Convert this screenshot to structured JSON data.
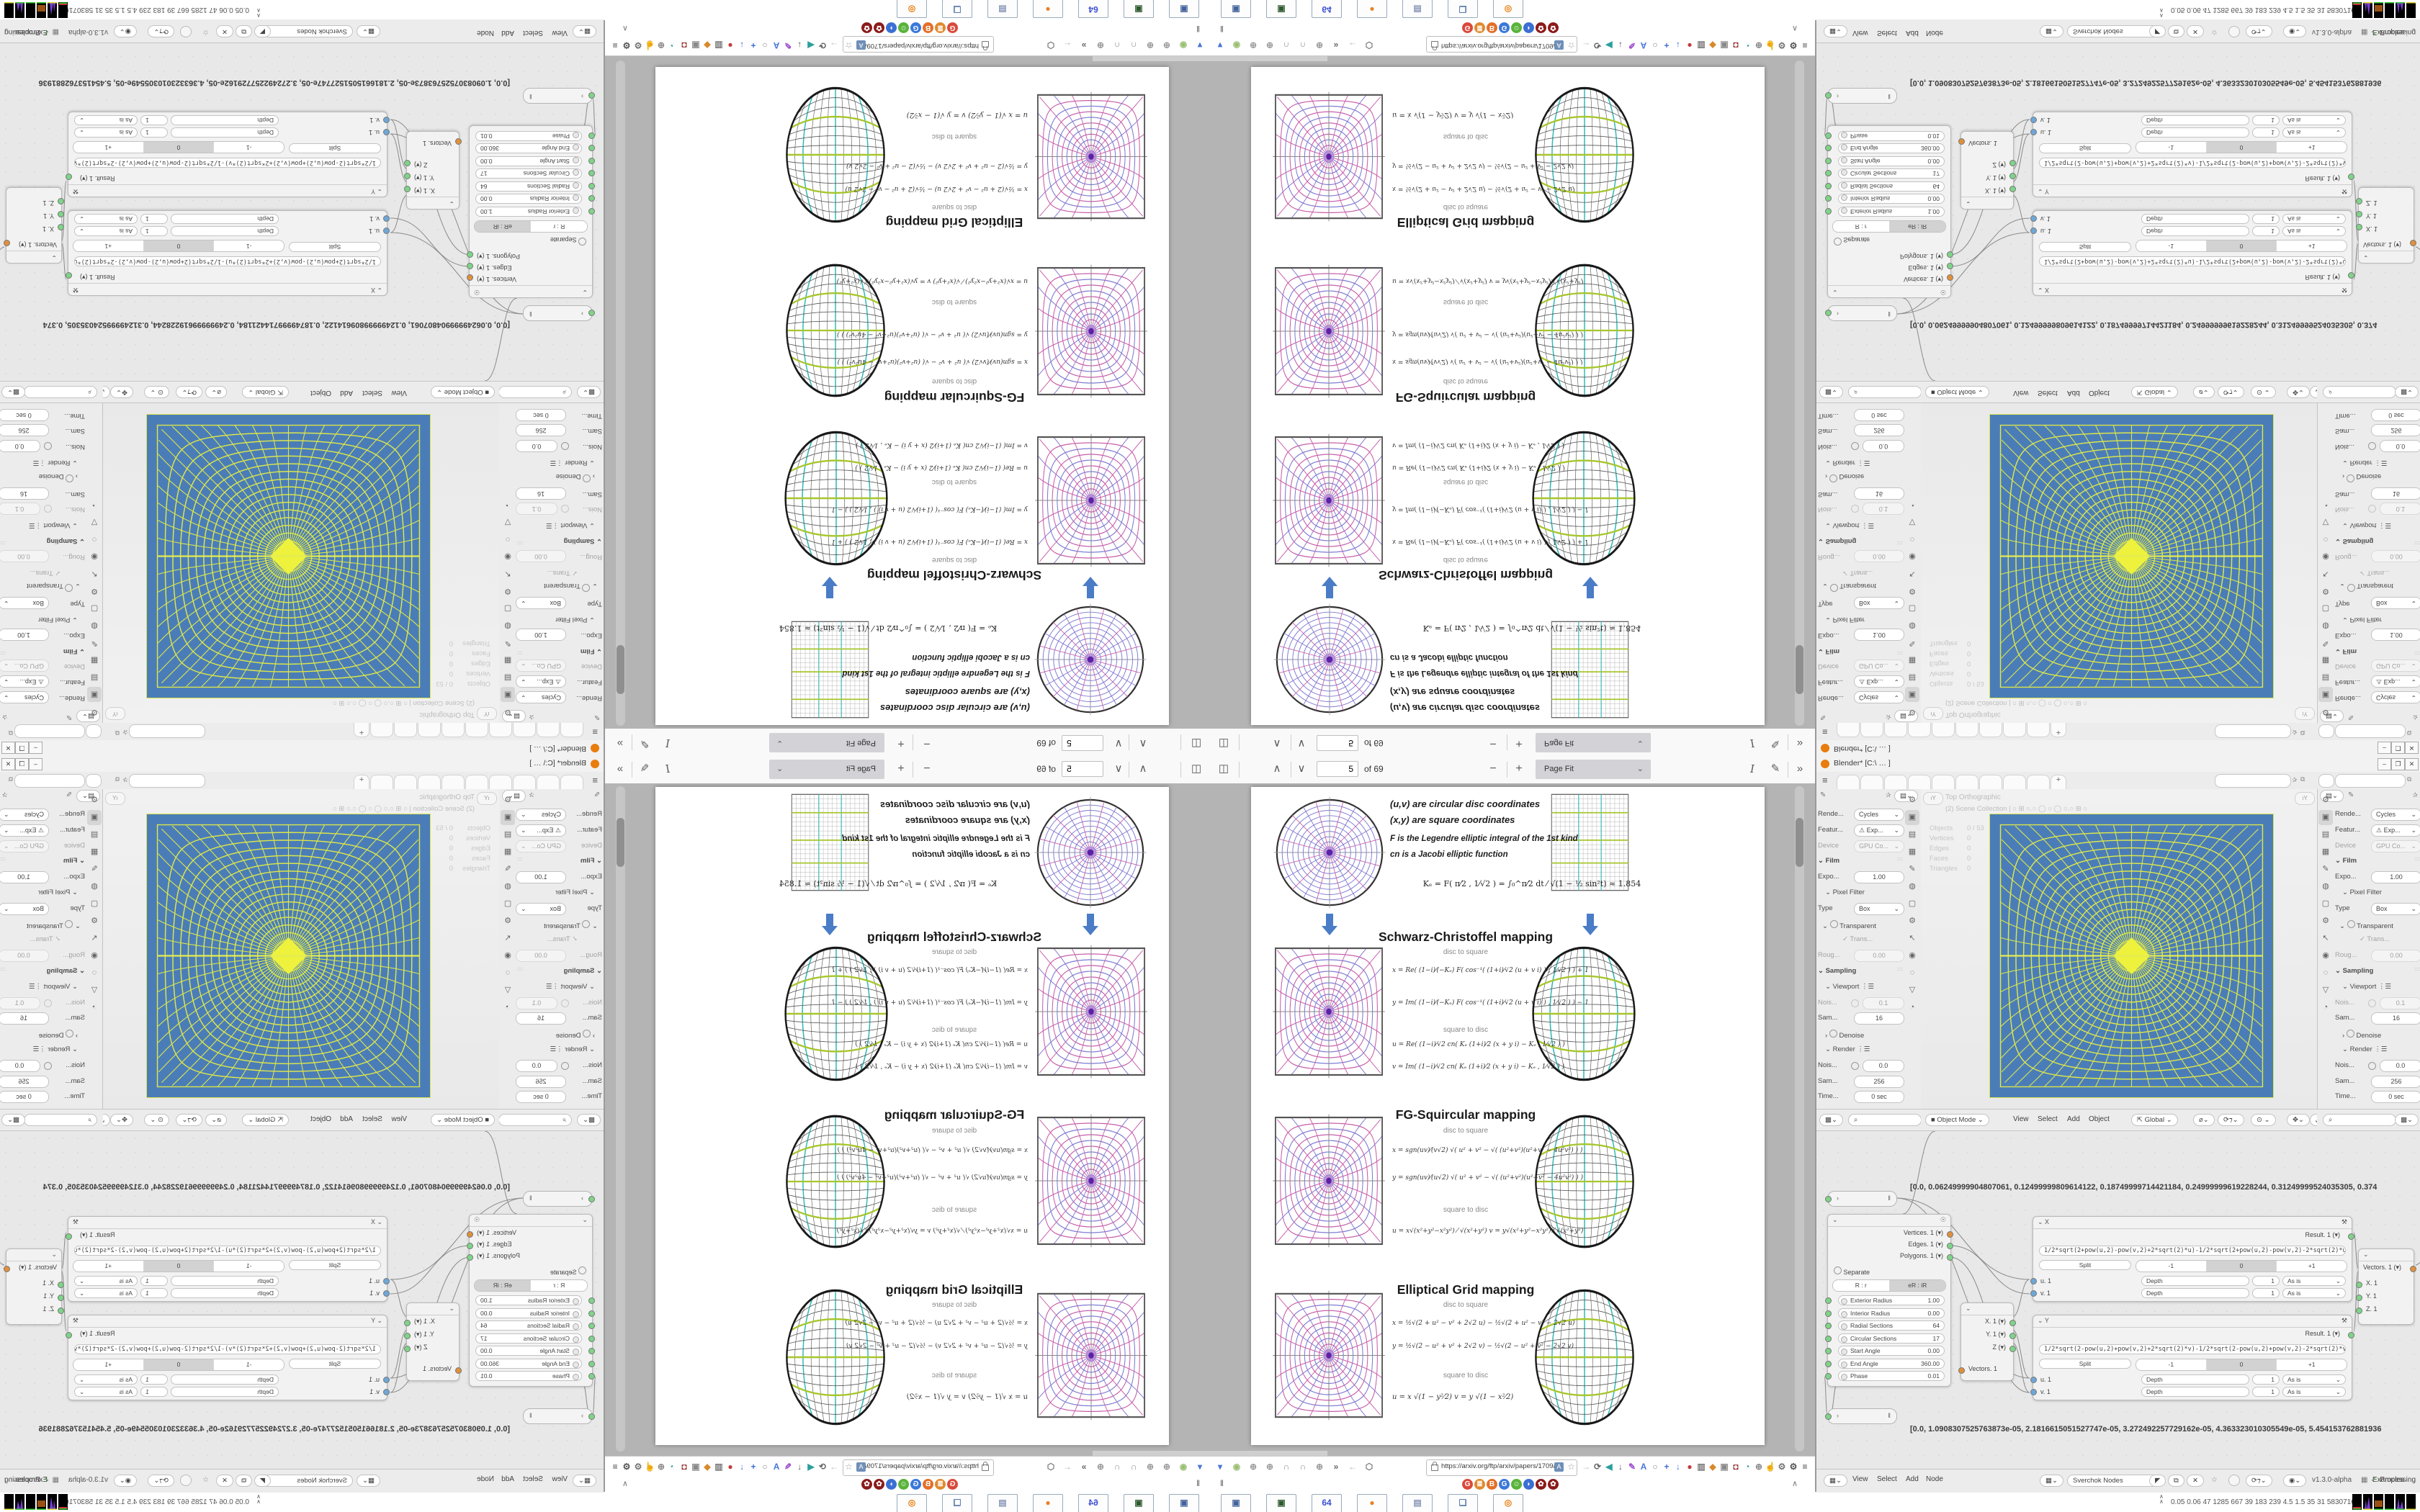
{
  "colors": {
    "accent_blue": "#4a7cc7",
    "viewport_blue": "#4a7db8",
    "grid_yellow": "#dce64a",
    "teal": "#35b8b8",
    "green_line": "#a7c62e",
    "ring_blue": "#7b7bd4",
    "radial_pink": "#c75da8"
  },
  "pdf_viewer": {
    "toolbar": {
      "page_input": "5",
      "page_count": "of 69",
      "zoom_out": "−",
      "zoom_in": "+",
      "zoom_value": "Page Fit",
      "sidebar_icon": "◫",
      "prev_icon": "∧",
      "next_icon": "∨",
      "text_tool": "I",
      "draw_tool": "✎",
      "overflow": "»"
    },
    "page": {
      "intro": [
        "(u,v)  are circular disc coordinates",
        "(x,y)  are square coordinates",
        "F  is the Legendre elliptic integral of the 1st kind",
        "cn  is a Jacobi elliptic function"
      ],
      "k_equation": "Kₑ =  F( π⁄2 , 1⁄√2 )  =  ∫₀^π⁄2  dt ⁄ √(1 − ½ sin²t)   ≈ 1.854",
      "sections": [
        {
          "title": "Schwarz-Christoffel mapping",
          "d2s_label": "disc to square",
          "s2d_label": "square to disc",
          "d2s": [
            "x = Re( (1−i)⁄(−Kₑ) F( cos⁻¹( (1+i)⁄√2 (u + v i) ) , 1⁄√2 ) ) + 1",
            "y = Im( (1−i)⁄(−Kₑ) F( cos⁻¹( (1+i)⁄√2 (u + v i) ) , 1⁄√2 ) ) − 1"
          ],
          "s2d": [
            "u = Re( (1−i)⁄√2  cn( Kₑ (1+i)⁄2 (x + y i) − Kₑ , 1⁄√2 ) )",
            "v = Im( (1−i)⁄√2  cn( Kₑ (1+i)⁄2 (x + y i) − Kₑ , 1⁄√2 ) )"
          ]
        },
        {
          "title": "FG-Squircular mapping",
          "d2s_label": "disc to square",
          "s2d_label": "square to disc",
          "d2s": [
            "x = sgn(uv)⁄(v√2) √( u² + v² − √( (u²+v²)(u²+v² − 4u²v²) ) )",
            "y = sgn(uv)⁄(u√2) √( u² + v² − √( (u²+v²)(u²+v² − 4u²v²) ) )"
          ],
          "s2d": [
            "u = x√(x²+y²−x²y²) ⁄ √(x²+y²)         v = y√(x²+y²−x²y²) ⁄ √(x²+y²)"
          ]
        },
        {
          "title": "Elliptical Grid mapping",
          "d2s_label": "disc to square",
          "s2d_label": "square to disc",
          "d2s": [
            "x = ½√(2 + u² − v² + 2√2 u)  −  ½√(2 + u² − v² − 2√2 u)",
            "y = ½√(2 − u² + v² + 2√2 v)  −  ½√(2 − u² + v² − 2√2 v)"
          ],
          "s2d": [
            "u = x √(1 − y²⁄2)             v = y √(1 − x²⁄2)"
          ]
        }
      ]
    }
  },
  "browser_chrome": {
    "url": "https://arxiv.org/ftp/arxiv/papers/1709/170",
    "left_icons": [
      {
        "g": "▾",
        "c": "#4a76d8"
      },
      {
        "g": "◉",
        "c": "#9bbf72"
      },
      {
        "g": "⊕",
        "c": "#9a9a9a"
      },
      {
        "g": "⊕",
        "c": "#9a9a9a"
      },
      {
        "g": "∩",
        "c": "#8f8f8f"
      },
      {
        "g": "∩",
        "c": "#8f8f8f"
      },
      {
        "g": "⊕",
        "c": "#9a9a9a"
      },
      {
        "g": "»",
        "c": "#666"
      },
      {
        "g": "←",
        "c": "#b0b0b0"
      },
      {
        "g": "⬡",
        "c": "#777"
      }
    ],
    "right_icons": [
      {
        "g": "→",
        "c": "#b9b9b9"
      },
      {
        "g": "⟳",
        "c": "#666"
      },
      {
        "g": "◀",
        "c": "#2e9e9e"
      },
      {
        "g": "↓",
        "c": "#555"
      },
      {
        "g": "✎",
        "c": "#a04fd0"
      },
      {
        "g": "A",
        "c": "#4a76d8"
      },
      {
        "g": "○",
        "c": "#888"
      },
      {
        "g": "+",
        "c": "#3f6fd0"
      },
      {
        "g": "↓",
        "c": "#3f6fd0"
      },
      {
        "g": "●",
        "c": "#c43c3c"
      },
      {
        "g": "▥",
        "c": "#7a7a7a"
      },
      {
        "g": "◆",
        "c": "#d98a2b"
      },
      {
        "g": "▣",
        "c": "#8a8a8a"
      },
      {
        "g": "◘",
        "c": "#8b1a1a"
      },
      {
        "g": "◔",
        "c": "#2e9e9e"
      },
      {
        "g": "⊕",
        "c": "#888"
      },
      {
        "g": "☝",
        "c": "#777"
      },
      {
        "g": "⚙",
        "c": "#777"
      },
      {
        "g": "⚙",
        "c": "#555"
      },
      {
        "g": "≡",
        "c": "#444"
      }
    ],
    "bookmarks": [
      {
        "g": "G",
        "c": "#d94a3c"
      },
      {
        "g": "≣",
        "c": "#e08a2e"
      },
      {
        "g": "B",
        "c": "#e2702a"
      },
      {
        "g": "G",
        "c": "#3b78d8"
      },
      {
        "g": "☺",
        "c": "#59b33a"
      },
      {
        "g": "◗",
        "c": "#3b6fd4"
      },
      {
        "g": "✿",
        "c": "#8b1a1a"
      },
      {
        "g": "✿",
        "c": "#8b1a1a"
      }
    ],
    "pause_glyph": "‖",
    "collapse_glyph": "∧"
  },
  "taskbar": {
    "items": [
      {
        "g": "▣",
        "c": "#44639c"
      },
      {
        "g": "▣",
        "c": "#2e5a2e"
      },
      {
        "g": "64",
        "c": "#3b4fd0"
      },
      {
        "g": "●",
        "c": "#e8822a"
      },
      {
        "g": "▤",
        "c": "#8a96b8"
      },
      {
        "g": "❏",
        "c": "#5577aa"
      },
      {
        "g": "◎",
        "c": "#e87d0d"
      }
    ]
  },
  "system_monitor": {
    "chevron": "∧",
    "values": "0.05 0.06    47    1285 667    39    183    239    4.5    1.5    35    31    58307169"
  },
  "blender": {
    "title": "Blender*  [C:\\ … ]",
    "window_buttons": [
      "–",
      "❐",
      "✕"
    ],
    "topbar": {
      "menu_glyph": "≡",
      "tab_count": 9,
      "new_tab": "+"
    },
    "props": {
      "tabs": [
        "⚙",
        "▣",
        "▤",
        "▦",
        "✎",
        "◍",
        "▢",
        "⚙",
        "↖",
        "◉",
        "◌",
        "▽",
        "◔"
      ],
      "active_tab_index": 1,
      "rows": [
        {
          "k": "dd",
          "label": "Rende...",
          "value": "Cycles"
        },
        {
          "k": "dd",
          "label": "Featur...",
          "value": "⚠ Exp..."
        },
        {
          "k": "dd",
          "label": "Device",
          "value": "GPU Co...",
          "dim": true
        },
        {
          "k": "sec",
          "label": "Film"
        },
        {
          "k": "slider",
          "label": "Expo...",
          "value": "1.00"
        },
        {
          "k": "sec2",
          "label": "Pixel Filter"
        },
        {
          "k": "dd",
          "label": "Type",
          "value": "Box"
        },
        {
          "k": "chk",
          "label": "Transparent"
        },
        {
          "k": "chk2",
          "label": "✓ Trans...",
          "dim": true
        },
        {
          "k": "slider",
          "label": "Roug...",
          "value": "0.00",
          "dim": true
        },
        {
          "k": "sec",
          "label": "Sampling"
        },
        {
          "k": "sec2",
          "label": "Viewport",
          "menu": true
        },
        {
          "k": "sliderc",
          "label": "Nois...",
          "value": "0.1",
          "dim": true
        },
        {
          "k": "slider",
          "label": "Sam...",
          "value": "16"
        },
        {
          "k": "chk3",
          "label": "Denoise"
        },
        {
          "k": "sec2",
          "label": "Render",
          "menu": true
        },
        {
          "k": "sliderc",
          "label": "Nois...",
          "value": "0.0"
        },
        {
          "k": "slider",
          "label": "Sam...",
          "value": "256"
        },
        {
          "k": "slider",
          "label": "Time...",
          "value": "0 sec"
        }
      ]
    },
    "viewport": {
      "view_label": "Top Orthographic",
      "collection_label": "(2) Scene Collection | ○ ⊞ ○.○ ◯ ○ ◯ ○.○ ⊞ ○",
      "stats": [
        [
          "Objects",
          "0 / 53"
        ],
        [
          "Vertices",
          "0"
        ],
        [
          "Edges",
          "0"
        ],
        [
          "Faces",
          "0"
        ],
        [
          "Triangles",
          "0"
        ]
      ],
      "header": {
        "mode": "Object Mode",
        "menus": [
          "View",
          "Select",
          "Add",
          "Object"
        ],
        "orientation": "Global"
      }
    },
    "node_editor": {
      "stetho_top": "[0.0, 0.06249999904807061, 0.12499999809614122, 0.18749999714421184, 0.24999999619228244, 0.31249999524035305, 0.374",
      "stetho_bottom": "[0.0, 1.0908307525763873e-05, 2.1816615051527747e-05, 3.272492257729162e-05, 4.363323010305549e-05, 5.454153762881936",
      "ring_node": {
        "outputs": [
          "Vertices. 1",
          "Edges. 1",
          "Polygons. 1"
        ],
        "separate_label": "Separate",
        "mode_options": [
          "R : r",
          "eR : iR"
        ],
        "mode_selected": 1,
        "params": [
          [
            "Exterior Radius",
            "1.00"
          ],
          [
            "Interior Radius",
            "0.00"
          ],
          [
            "Radial Sections",
            "64"
          ],
          [
            "Circular Sections",
            "17"
          ],
          [
            "Start Angle",
            "0.00"
          ],
          [
            "End Angle",
            "360.00"
          ],
          [
            "Phase",
            "0.01"
          ]
        ]
      },
      "vector_in": {
        "inputs": [
          "X. 1",
          "Y. 1",
          "Z"
        ],
        "output": "Vectors. 1"
      },
      "vector_out": {
        "input": "Vectors. 1",
        "outputs": [
          "X. 1",
          "Y. 1",
          "Z. 1"
        ]
      },
      "formula_nodes": [
        {
          "title": "X",
          "formula": "1/2*sqrt(2+pow(u,2)-pow(v,2)+2*sqrt(2)*u)-1/2*sqrt(2+pow(u,2)-pow(v,2)-2*sqrt(2)*u)",
          "result": "Result. 1",
          "wrap_options": [
            "Split",
            "-1",
            "0",
            "+1"
          ],
          "wrap_selected": 2,
          "rows": [
            [
              "u. 1",
              "Depth",
              "1",
              "As is"
            ],
            [
              "v. 1",
              "Depth",
              "1",
              "As is"
            ]
          ]
        },
        {
          "title": "Y",
          "formula": "1/2*sqrt(2-pow(u,2)+pow(v,2)+2*sqrt(2)*v)-1/2*sqrt(2-pow(u,2)+pow(v,2)-2*sqrt(2)*v)",
          "result": "Result. 1",
          "wrap_options": [
            "Split",
            "-1",
            "0",
            "+1"
          ],
          "wrap_selected": 2,
          "rows": [
            [
              "u. 1",
              "Depth",
              "1",
              "As is"
            ],
            [
              "v. 1",
              "Depth",
              "1",
              "As is"
            ]
          ]
        }
      ],
      "header": {
        "menus": [
          "View",
          "Select",
          "Add",
          "Node"
        ],
        "tree_name": "Sverchok Nodes",
        "version": "v1.3.0-alpha",
        "examples": "Examples",
        "processing": "Processing",
        "check": "✓"
      }
    }
  }
}
